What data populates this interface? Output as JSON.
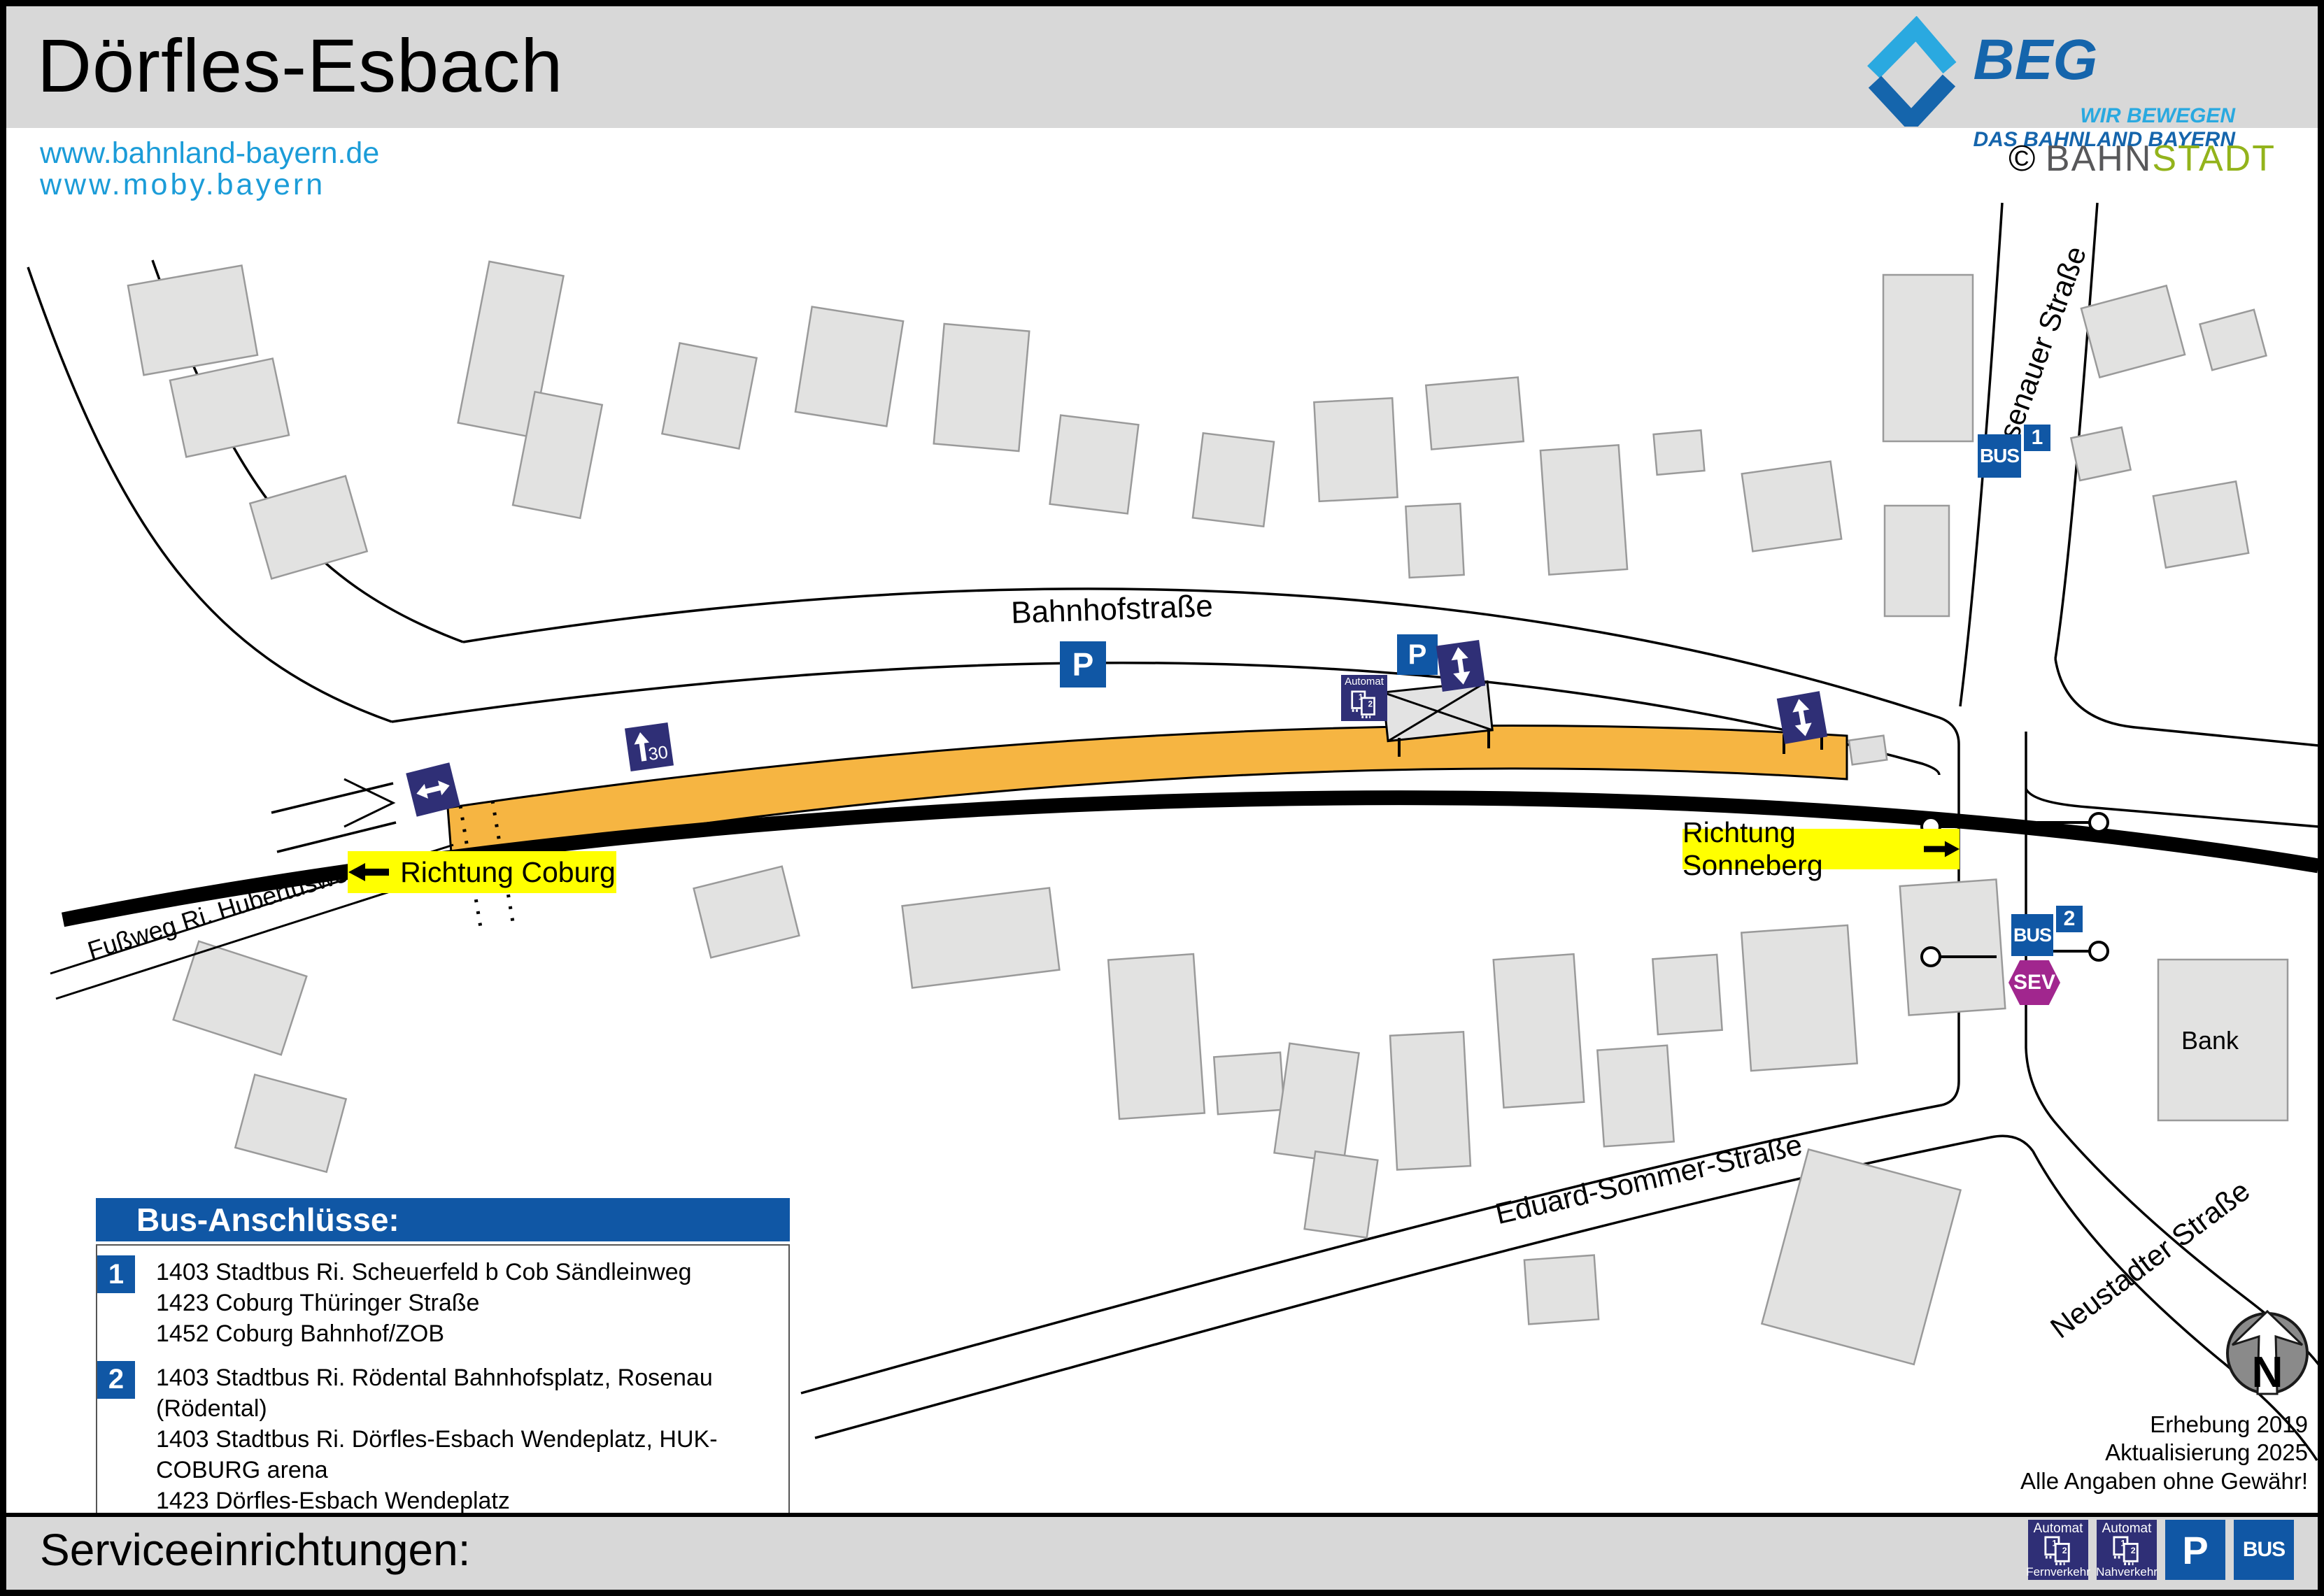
{
  "header": {
    "title": "Dörfles-Esbach",
    "links": {
      "line1": "www.bahnland-bayern.de",
      "line2": "www.moby.bayern"
    },
    "beg": {
      "name": "BEG",
      "tagline1": "WIR BEWEGEN",
      "tagline2": "DAS BAHNLAND BAYERN"
    },
    "credit": {
      "symbol": "©",
      "part1": "BAHN",
      "part2": "STADT"
    }
  },
  "map": {
    "streets": {
      "bahnhofstrasse": "Bahnhofstraße",
      "rosenauer": "Rosenauer Straße",
      "eduard_sommer": "Eduard-Sommer-Straße",
      "neustadter": "Neustadter Straße",
      "fussweg": "Fußweg Ri. Hubertusweg"
    },
    "directions": {
      "coburg": "Richtung Coburg",
      "sonneberg": "Richtung Sonneberg"
    },
    "labels": {
      "bank": "Bank"
    },
    "icons": {
      "platform_marker": "30",
      "automat": "Automat",
      "ticket1": "1",
      "ticket2": "2",
      "parking": "P",
      "bus": "BUS",
      "bus_stop_1": "1",
      "bus_stop_2": "2",
      "sev": "SEV"
    },
    "compass": "N"
  },
  "legend": {
    "title": "Bus-Anschlüsse:",
    "groups": [
      {
        "number": "1",
        "lines": [
          "1403 Stadtbus Ri. Scheuerfeld b Cob Sändleinweg",
          "1423 Coburg Thüringer Straße",
          "1452 Coburg Bahnhof/ZOB"
        ]
      },
      {
        "number": "2",
        "lines": [
          "1403 Stadtbus Ri. Rödental Bahnhofsplatz, Rosenau (Rödental)",
          "1403 Stadtbus Ri. Dörfles-Esbach Wendeplatz, HUK-COBURG arena",
          "1423 Dörfles-Esbach Wendeplatz",
          "1452 Neustadt (Cob) Einkaufszentrum"
        ]
      }
    ]
  },
  "notes": {
    "line1": "Erhebung 2019",
    "line2": "Aktualisierung 2025",
    "line3": "Alle Angaben ohne Gewähr!"
  },
  "footer": {
    "title": "Serviceeinrichtungen:",
    "icons": [
      {
        "name": "automat-fernverkehr",
        "label": "Automat",
        "sublabel": "Fernverkehr"
      },
      {
        "name": "automat-nahverkehr",
        "label": "Automat",
        "sublabel": "Nahverkehr"
      },
      {
        "name": "parking",
        "label": "P"
      },
      {
        "name": "bus",
        "label": "BUS"
      }
    ]
  },
  "colors": {
    "header_gray": "#d8d8d8",
    "building_fill": "#e2e2e1",
    "building_stroke": "#9a9a9a",
    "platform_orange": "#f6b542",
    "icon_navy": "#2f2f76",
    "icon_blue": "#1057a5",
    "direction_yellow": "#ffff00",
    "sev_magenta": "#a1268e",
    "link_blue": "#1b9cd8",
    "beg_dark_blue": "#1565ac",
    "beg_light_blue": "#2aa9e0",
    "bahnstadt_green": "#93b31b"
  }
}
